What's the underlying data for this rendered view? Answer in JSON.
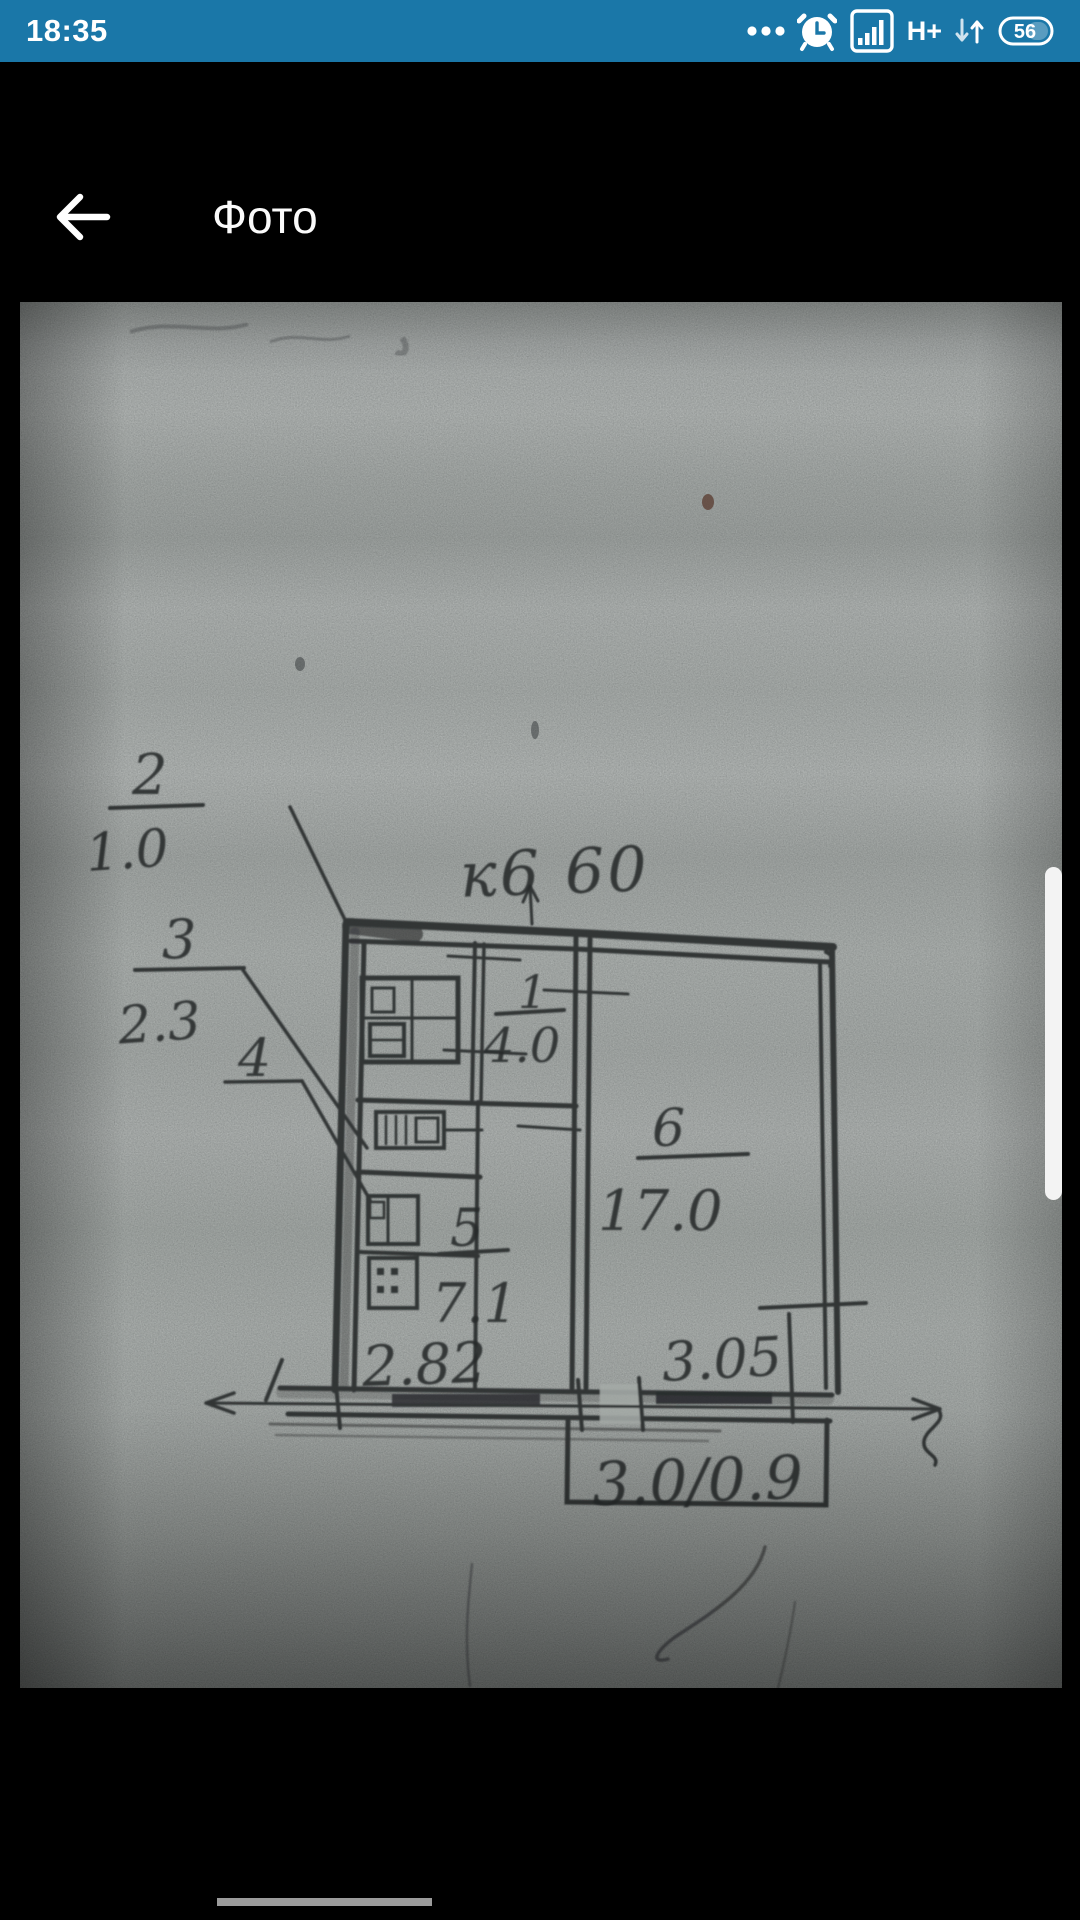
{
  "status_bar": {
    "time": "18:35",
    "network_type": "H+",
    "battery_percent": "56",
    "bg_color": "#1a77a8"
  },
  "app_bar": {
    "title": "Фото",
    "bg_color": "#000000"
  },
  "photo": {
    "description": "scanned hand-drawn apartment floor plan on gray paper",
    "paper_color": "#a4aaa6",
    "ink_color": "#26292b",
    "plan_labels": {
      "top_dimension": "к6 60",
      "callout_2": {
        "num": "2",
        "value": "1.0"
      },
      "callout_3": {
        "num": "3",
        "value": "2.3"
      },
      "callout_4": {
        "num": "4"
      },
      "room_1": {
        "num": "1",
        "area": "4.0"
      },
      "room_5": {
        "num": "5",
        "area": "7.1"
      },
      "room_6": {
        "num": "6",
        "area": "17.0"
      },
      "bottom_dim_left": "2.82",
      "bottom_dim_right": "3.05",
      "balcony_dim": "3.0/0.9"
    }
  },
  "scrollbar_color": "#f3f3f3",
  "bottom_indicator_color": "#9b9b9b"
}
